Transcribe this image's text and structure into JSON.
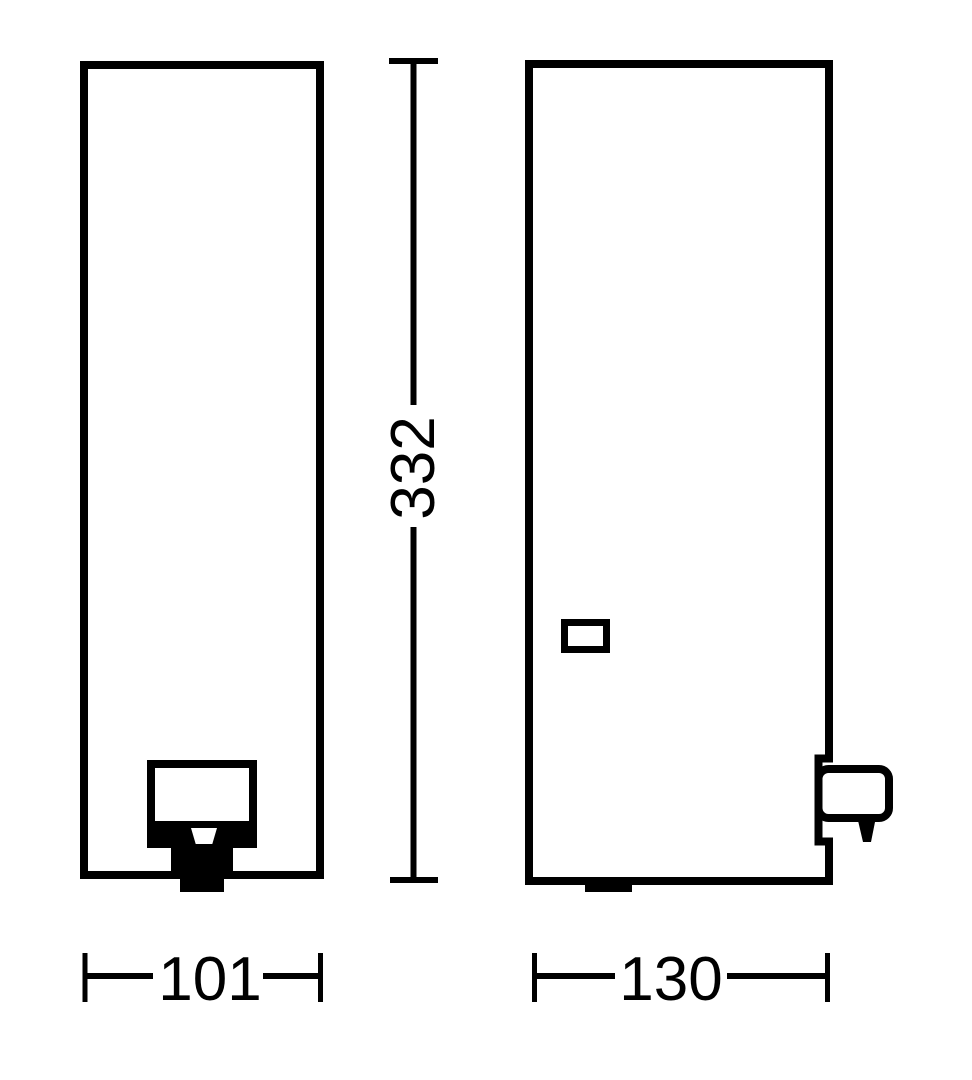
{
  "drawing": {
    "type": "technical-dimension-drawing",
    "subject": "dispenser front and side elevation views",
    "labels": {
      "height": "332",
      "front_width": "101",
      "side_width": "130"
    },
    "colors": {
      "line": "#000000",
      "background": "#ffffff"
    }
  }
}
